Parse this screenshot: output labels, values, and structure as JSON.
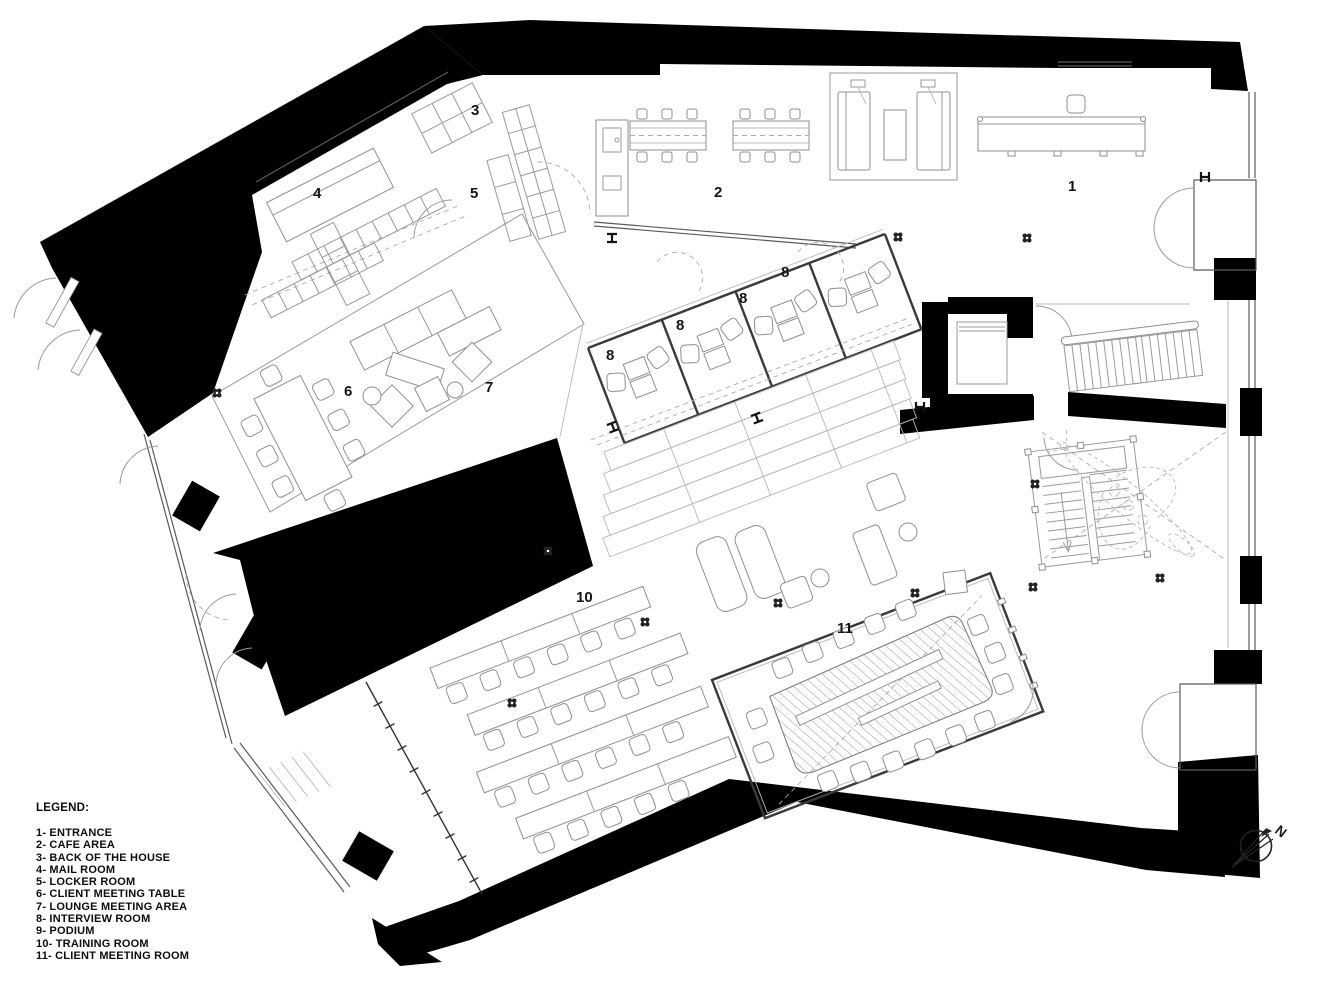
{
  "legend": {
    "title": "LEGEND:",
    "items": [
      "1- ENTRANCE",
      "2- CAFE AREA",
      "3- BACK OF THE HOUSE",
      "4- MAIL ROOM",
      "5- LOCKER ROOM",
      "6- CLIENT MEETING TABLE",
      "7- LOUNGE MEETING AREA",
      "8- INTERVIEW ROOM",
      "9- PODIUM",
      "10- TRAINING ROOM",
      "11- CLIENT MEETING ROOM"
    ]
  },
  "plan_labels": {
    "entrance": "1",
    "cafe_area": "2",
    "back_of_the_house": "3",
    "mail_room": "4",
    "locker_room": "5",
    "client_meeting_table": "6",
    "lounge_meeting_area": "7",
    "interview_room": "8",
    "training_room": "10",
    "client_meeting_room": "11"
  },
  "north_arrow": {
    "label": "N"
  },
  "colors": {
    "wall_poche": "#000000",
    "partition": "#3a3a3a",
    "furniture_line": "#8f8f8f",
    "light_line": "#b7b7b7",
    "background": "#ffffff"
  }
}
